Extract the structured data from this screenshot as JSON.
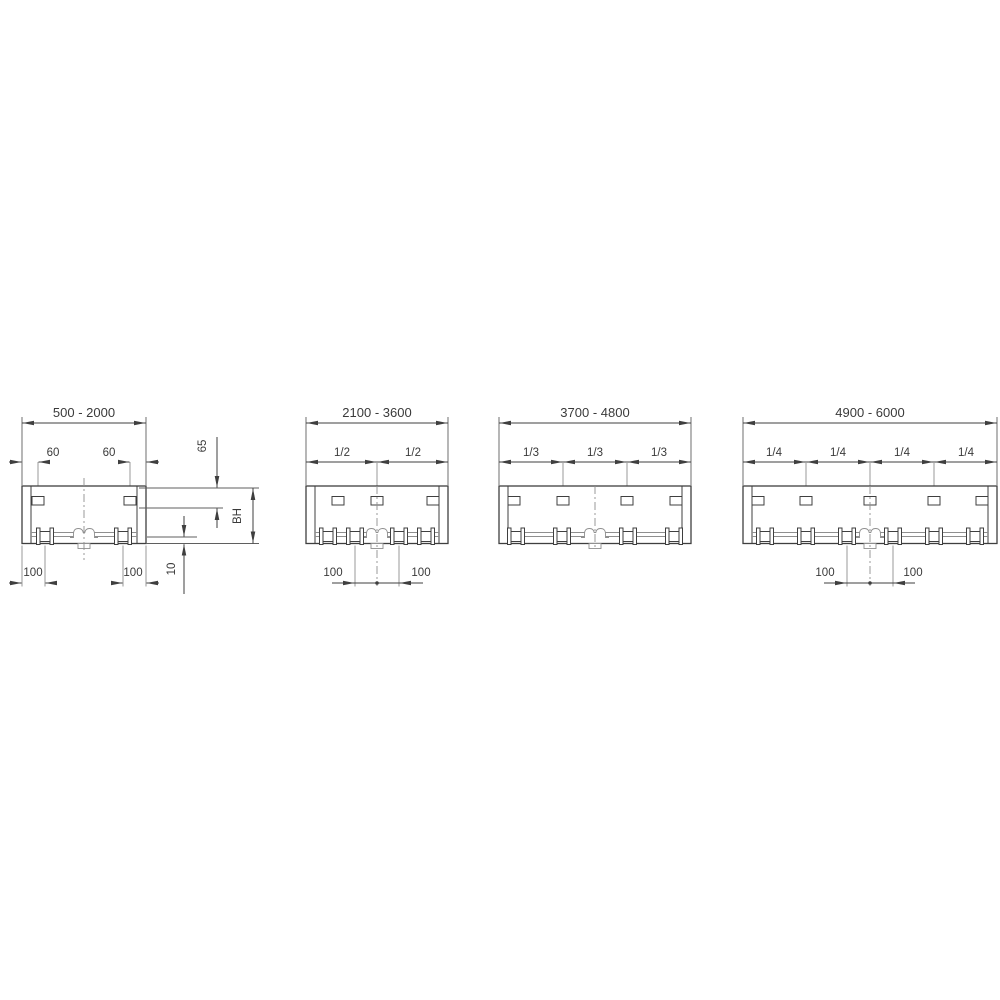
{
  "colors": {
    "line": "#3f3f3f",
    "extension": "#8f8f8f",
    "text": "#3a3a3a",
    "background": "#ffffff"
  },
  "panels": [
    {
      "range": "500 - 2000",
      "bracket_offset_left": "60",
      "bracket_offset_right": "60",
      "top_height": "65",
      "build_height": "BH",
      "bottom_gap": "10",
      "foot_offset_left": "100",
      "foot_offset_right": "100"
    },
    {
      "range": "2100 - 3600",
      "fractions": [
        "1/2",
        "1/2"
      ],
      "foot_offset_left": "100",
      "foot_offset_right": "100"
    },
    {
      "range": "3700 - 4800",
      "fractions": [
        "1/3",
        "1/3",
        "1/3"
      ]
    },
    {
      "range": "4900 - 6000",
      "fractions": [
        "1/4",
        "1/4",
        "1/4",
        "1/4"
      ],
      "foot_offset_left": "100",
      "foot_offset_right": "100"
    }
  ]
}
